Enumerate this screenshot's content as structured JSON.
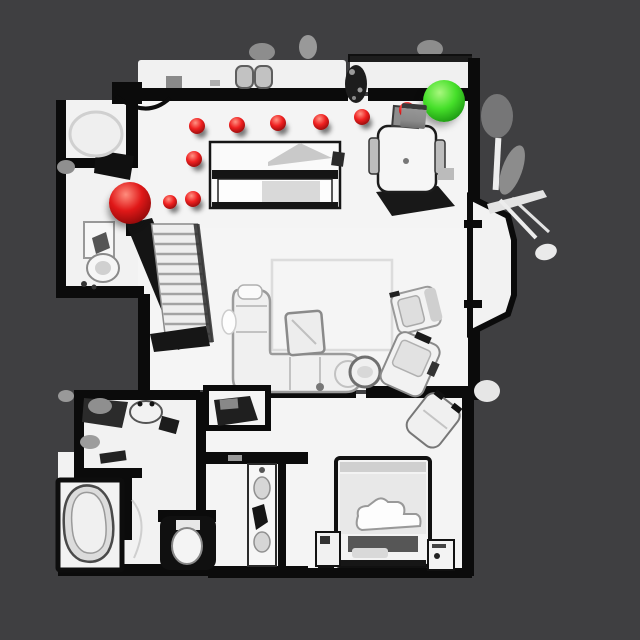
{
  "scene": {
    "type": "top-down-3d-scan-floor-map",
    "background_color": "#3f3f41",
    "floor_color": "#f3f3f3",
    "wall_color": "#0b0b0b"
  },
  "markers": {
    "waypoint_style": {
      "base": "#ef2020",
      "light": "#ff9384",
      "dark": "#6d0303"
    },
    "start_style": {
      "base": "#e01818",
      "light": "#ff8d7d",
      "dark": "#6d0303"
    },
    "goal_style": {
      "base": "#46e02a",
      "light": "#a8f77e",
      "dark": "#0b7a07"
    },
    "start": {
      "x": 130,
      "y": 203,
      "radius": 21
    },
    "goal": {
      "x": 444,
      "y": 101,
      "radius": 21
    },
    "waypoints": [
      {
        "x": 197,
        "y": 126,
        "radius": 8
      },
      {
        "x": 237,
        "y": 125,
        "radius": 8
      },
      {
        "x": 278,
        "y": 123,
        "radius": 8
      },
      {
        "x": 321,
        "y": 122,
        "radius": 8
      },
      {
        "x": 362,
        "y": 117,
        "radius": 8
      },
      {
        "x": 407,
        "y": 110,
        "radius": 8
      },
      {
        "x": 194,
        "y": 159,
        "radius": 8
      },
      {
        "x": 170,
        "y": 202,
        "radius": 7
      },
      {
        "x": 193,
        "y": 199,
        "radius": 8
      }
    ],
    "counts": {
      "waypoints": 9,
      "start": 1,
      "goal": 1
    }
  }
}
